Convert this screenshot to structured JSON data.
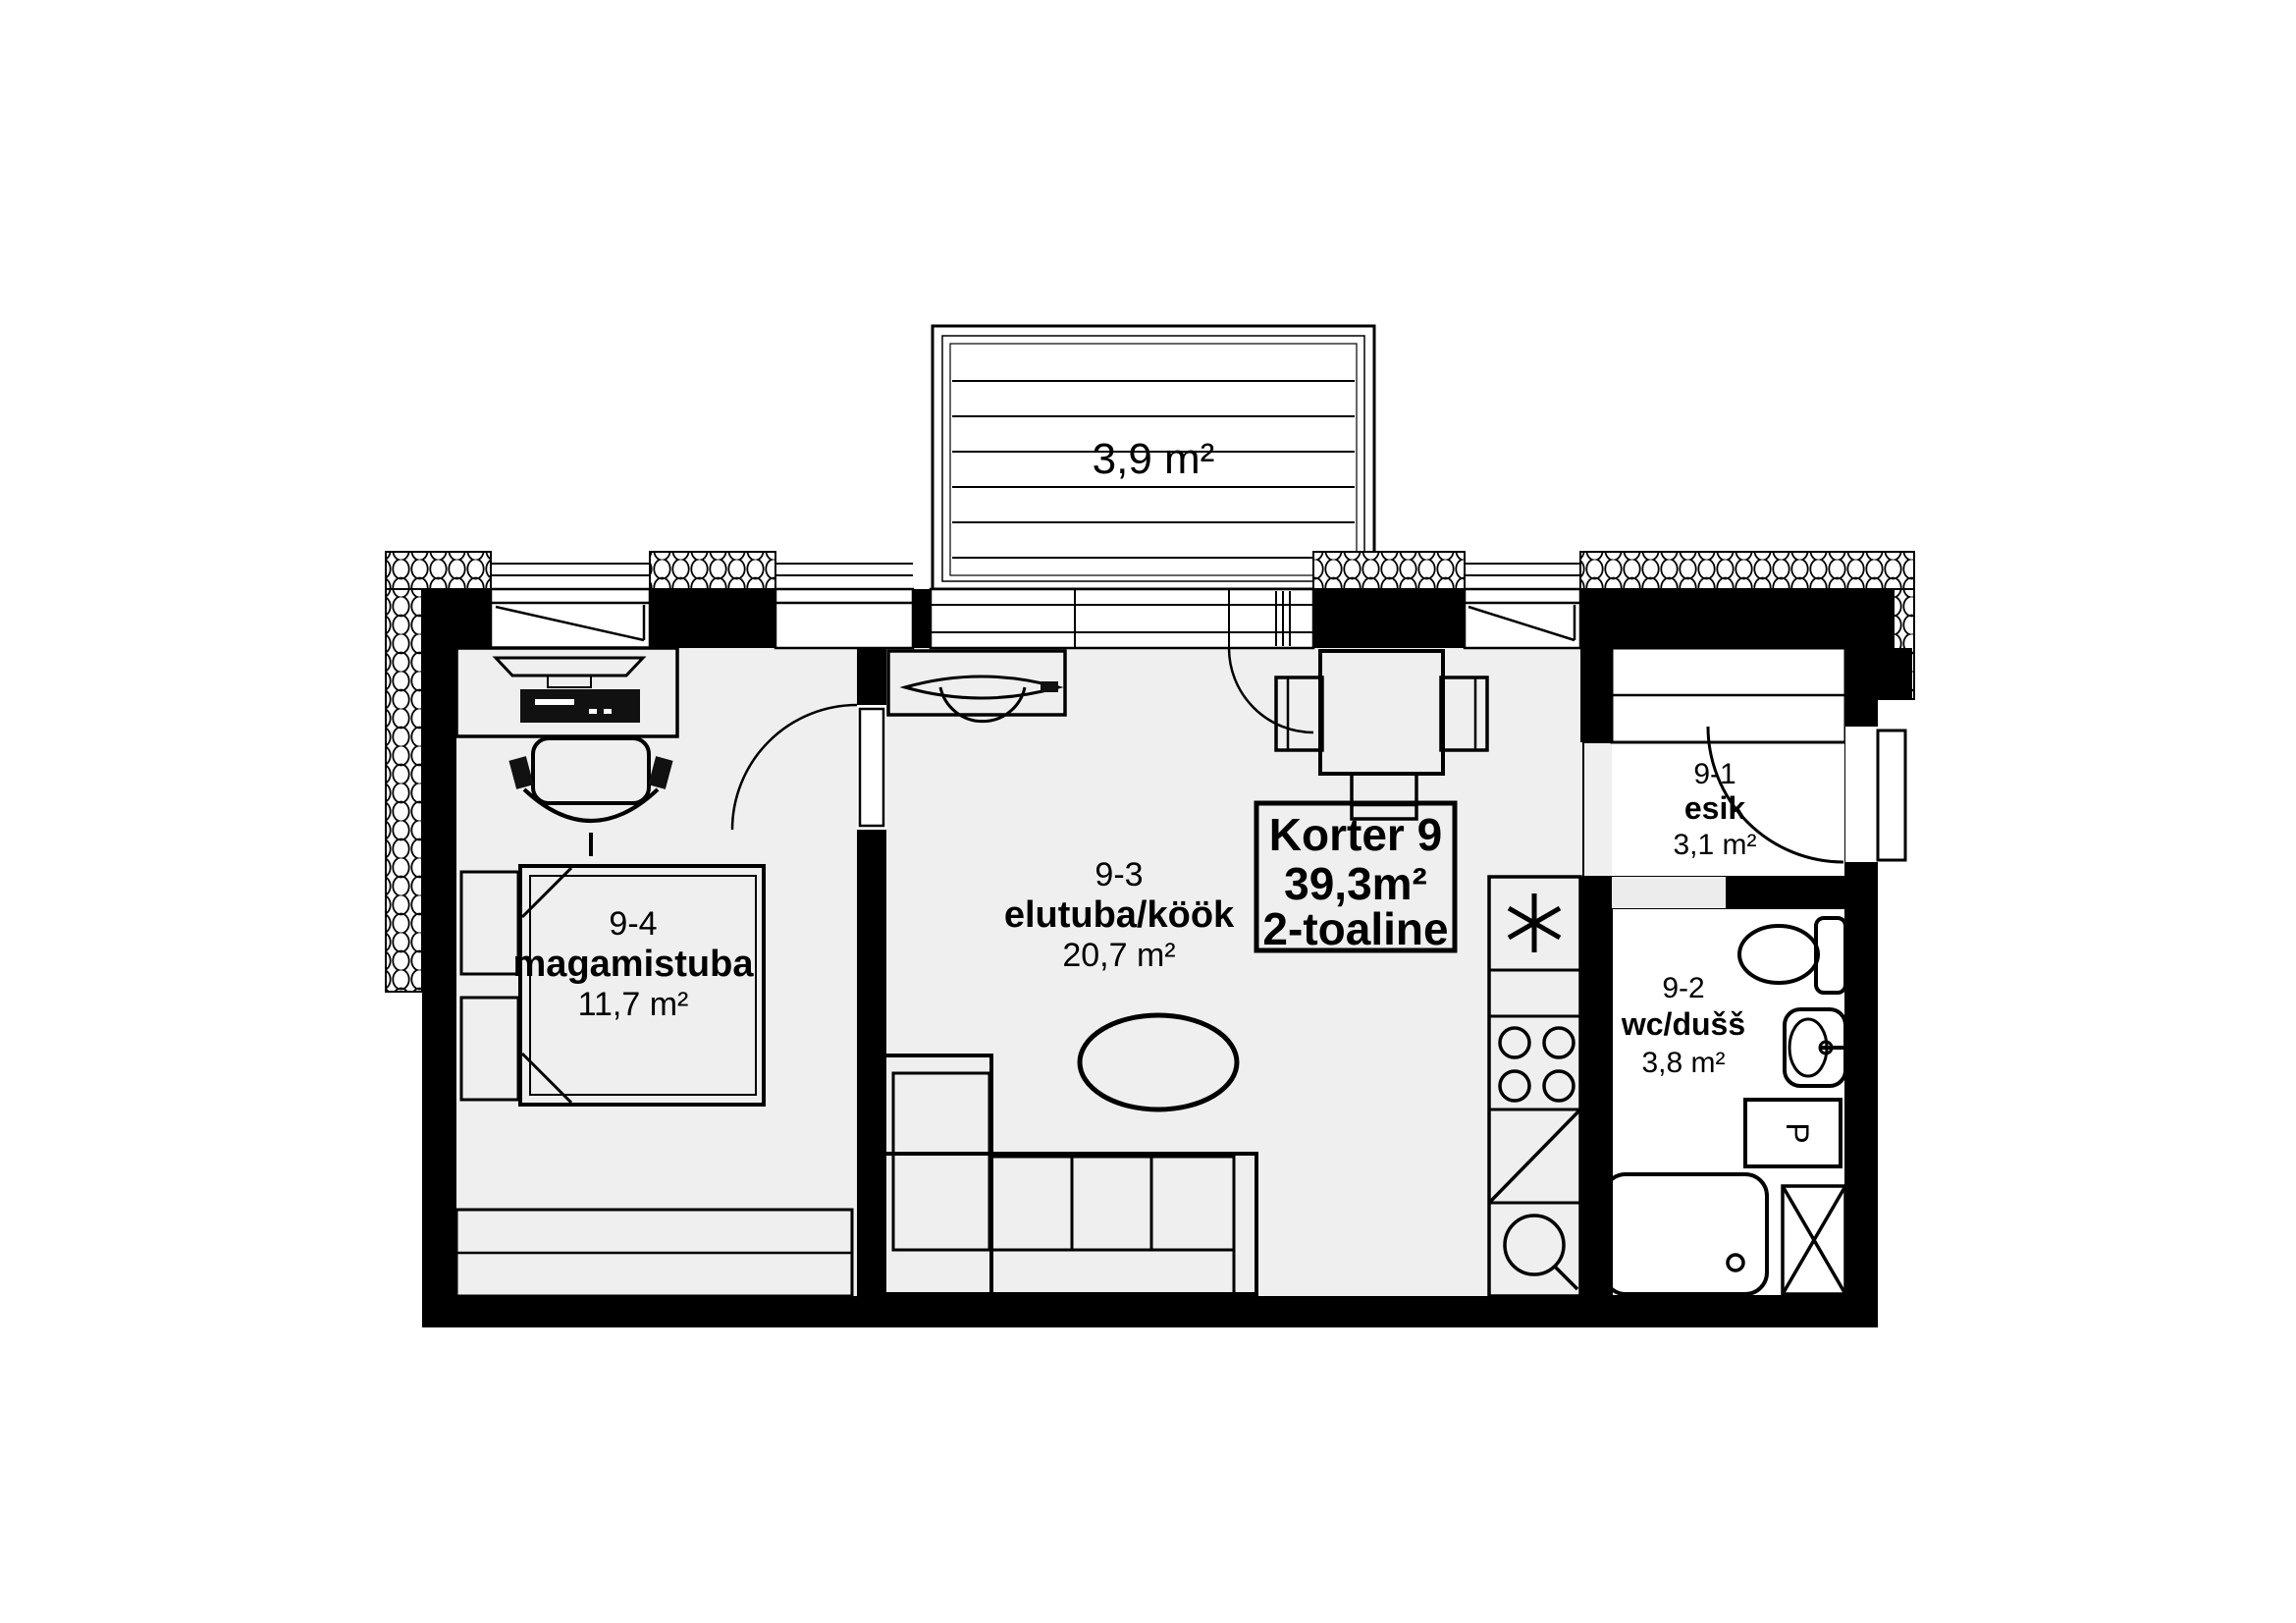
{
  "plan": {
    "title": {
      "name": "Korter 9",
      "area": "39,3m²",
      "type": "2-toaline"
    },
    "balcony": {
      "area": "3,9 m²"
    },
    "rooms": {
      "living": {
        "number": "9-3",
        "name": "elutuba/köök",
        "area": "20,7 m²"
      },
      "bedroom": {
        "number": "9-4",
        "name": "magamistuba",
        "area": "11,7 m²"
      },
      "hall": {
        "number": "9-1",
        "name": "esik",
        "area": "3,1 m²"
      },
      "bath": {
        "number": "9-2",
        "name": "wc/dušš",
        "area": "3,8 m²"
      }
    },
    "appliances": {
      "washer": "P"
    },
    "colors": {
      "wall": "#000000",
      "floor": "#efefef",
      "background": "#ffffff"
    }
  }
}
